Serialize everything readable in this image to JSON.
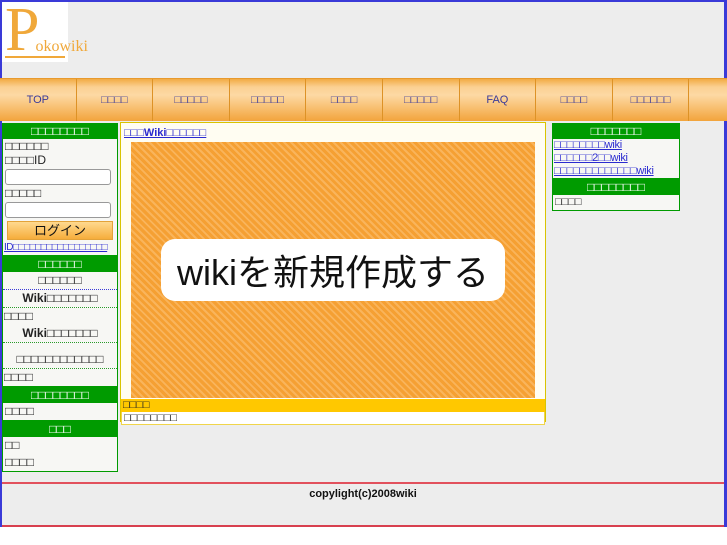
{
  "colors": {
    "frame_border_blue": "#3a3ad8",
    "background_gray": "#ededed",
    "logo_orange": "#f0a83a",
    "nav_text_navy": "#3b3b99",
    "header_green": "#009b00",
    "link_blue": "#2a2ad0",
    "banner_orange": "#f5a033",
    "notice_yellow": "#ffc800",
    "footer_line_red": "#e2515d"
  },
  "logo": {
    "initial": "P",
    "rest": "okowiki"
  },
  "nav": {
    "items": [
      "TOP",
      "□□□□",
      "□□□□□",
      "□□□□□",
      "□□□□",
      "□□□□□",
      "FAQ",
      "□□□□",
      "□□□□□□"
    ]
  },
  "left_sidebar": {
    "login": {
      "title": "□□□□□□□□",
      "intro_line": "□□□□□□",
      "id_label": "□□□□ID",
      "id_value": "",
      "password_label": "□□□□□",
      "password_value": "",
      "login_button": "ログイン",
      "register_link": "ID□□□□□□□□□□□□□□□□□"
    },
    "menu": {
      "title": "□□□□□□",
      "items": [
        "□□□□□□",
        "Wiki□□□□□□□",
        "□□□□",
        "Wiki□□□□□□□",
        "□□□□□□□□□□□□",
        "□□□□"
      ]
    },
    "section3": {
      "title": "□□□□□□□□",
      "item": "□□□□"
    },
    "section4": {
      "title": "□□□",
      "items": [
        "□□",
        "□□□□"
      ]
    }
  },
  "main": {
    "create_wiki_link": "□□□Wiki□□□□□□",
    "banner_text": "wikiを新規作成する",
    "notice_bar": "□□□□",
    "notice_item": "□□□□□□□□"
  },
  "right_sidebar": {
    "new_wikis": {
      "title": "□□□□□□□",
      "links": [
        "□□□□□□□□wiki",
        "□□□□□□2□□wiki",
        "□□□□□□□□□□□□□wiki"
      ]
    },
    "section2": {
      "title": "□□□□□□□□",
      "item": "□□□□"
    }
  },
  "footer": {
    "copyright": "copylight(c)2008wiki"
  }
}
